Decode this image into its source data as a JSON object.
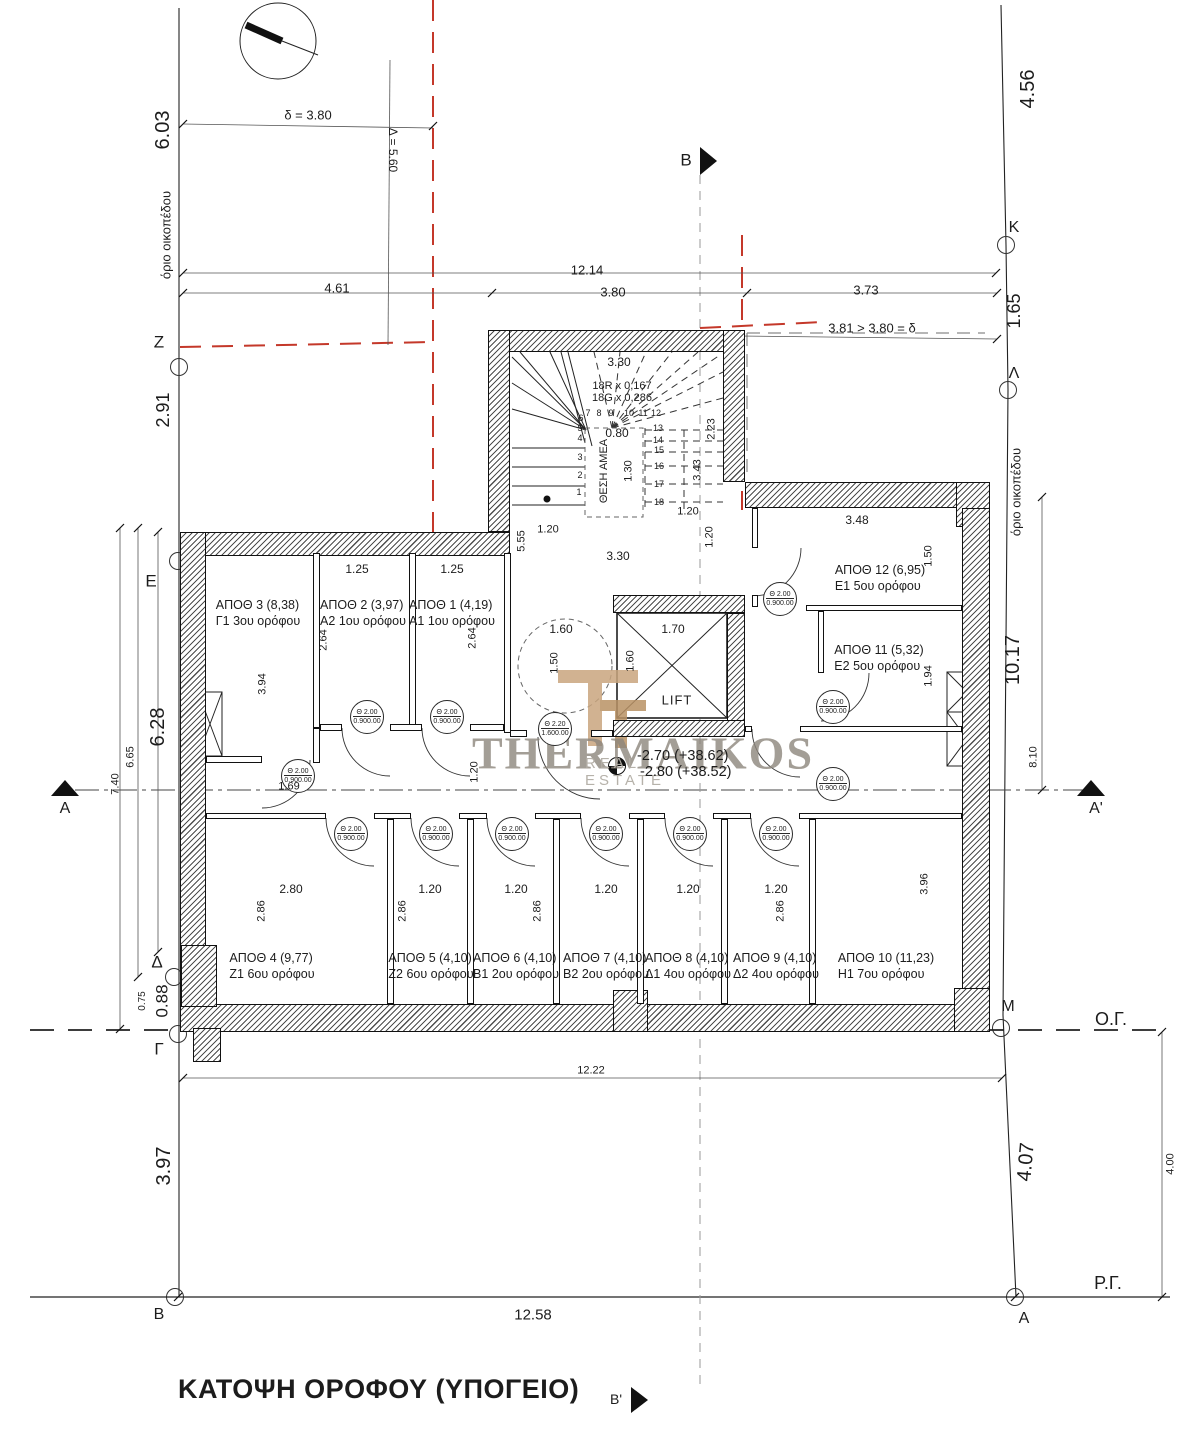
{
  "meta": {
    "title": "ΚΑΤΟΨΗ ΟΡΟΦΟΥ (ΥΠΟΓΕΙΟ)"
  },
  "watermark": {
    "brand": "THERMAIKOS",
    "subtitle": "REAL ESTATE",
    "logo_color": "#c9a57e",
    "brand_color": "#8d867c",
    "subtitle_color": "#b3aea6"
  },
  "lift": {
    "label": "LIFT"
  },
  "levels": {
    "line1": "-2.70 (+38.62)",
    "line2": "-2.80 (+38.52)"
  },
  "stairs": {
    "riser": "18R x 0,167",
    "going": "18G x 0,286",
    "amea": "ΘΕΣΗ ΑΜΕΑ",
    "steps": [
      {
        "n": "1",
        "x": 579,
        "y": 492
      },
      {
        "n": "2",
        "x": 580,
        "y": 475
      },
      {
        "n": "3",
        "x": 580,
        "y": 457
      },
      {
        "n": "4",
        "x": 580,
        "y": 438
      },
      {
        "n": "5",
        "x": 580,
        "y": 428
      },
      {
        "n": "6",
        "x": 581,
        "y": 418
      },
      {
        "n": "7",
        "x": 588,
        "y": 413
      },
      {
        "n": "8",
        "x": 599,
        "y": 413
      },
      {
        "n": "9",
        "x": 611,
        "y": 413
      },
      {
        "n": "10",
        "x": 629,
        "y": 413
      },
      {
        "n": "11",
        "x": 643,
        "y": 413
      },
      {
        "n": "12",
        "x": 656,
        "y": 413
      },
      {
        "n": "13",
        "x": 658,
        "y": 428
      },
      {
        "n": "14",
        "x": 658,
        "y": 440
      },
      {
        "n": "15",
        "x": 659,
        "y": 450
      },
      {
        "n": "16",
        "x": 659,
        "y": 466
      },
      {
        "n": "17",
        "x": 659,
        "y": 484
      },
      {
        "n": "18",
        "x": 659,
        "y": 502
      }
    ]
  },
  "doors": {
    "tag_line1": "Θ 2.00",
    "tag_line2": "0.900.00",
    "entrance_line1": "Θ 2.20",
    "entrance_line2": "1.600.00",
    "standard": [
      {
        "x": 366,
        "y": 716
      },
      {
        "x": 446,
        "y": 716
      },
      {
        "x": 297,
        "y": 775
      },
      {
        "x": 350,
        "y": 833
      },
      {
        "x": 435,
        "y": 833
      },
      {
        "x": 511,
        "y": 833
      },
      {
        "x": 605,
        "y": 833
      },
      {
        "x": 689,
        "y": 833
      },
      {
        "x": 775,
        "y": 833
      },
      {
        "x": 779,
        "y": 598
      },
      {
        "x": 832,
        "y": 706
      },
      {
        "x": 832,
        "y": 783
      }
    ],
    "entrance": {
      "x": 554,
      "y": 728
    }
  },
  "rooms": [
    {
      "name": "room-apoth-3",
      "label": "ΑΠΟΘ 3 (8,38)",
      "floor": "Γ1 3ου ορόφου",
      "x": 258,
      "y": 613
    },
    {
      "name": "room-apoth-2",
      "label": "ΑΠΟΘ 2 (3,97)",
      "floor": "Α2 1ου ορόφου",
      "x": 363,
      "y": 613
    },
    {
      "name": "room-apoth-1",
      "label": "ΑΠΟΘ 1 (4,19)",
      "floor": "Α1 1ου ορόφου",
      "x": 452,
      "y": 613
    },
    {
      "name": "room-apoth-12",
      "label": "ΑΠΟΘ 12 (6,95)",
      "floor": "Ε1 5ου ορόφου",
      "x": 880,
      "y": 578
    },
    {
      "name": "room-apoth-11",
      "label": "ΑΠΟΘ 11 (5,32)",
      "floor": "Ε2 5ου ορόφου",
      "x": 879,
      "y": 658
    },
    {
      "name": "room-apoth-4",
      "label": "ΑΠΟΘ 4 (9,77)",
      "floor": "Ζ1 6ου ορόφου",
      "x": 272,
      "y": 966
    },
    {
      "name": "room-apoth-5",
      "label": "ΑΠΟΘ 5 (4,10)",
      "floor": "Ζ2 6ου ορόφου",
      "x": 431,
      "y": 966
    },
    {
      "name": "room-apoth-6",
      "label": "ΑΠΟΘ 6 (4,10)",
      "floor": "Β1 2ου ορόφου",
      "x": 516,
      "y": 966
    },
    {
      "name": "room-apoth-7",
      "label": "ΑΠΟΘ 7 (4,10)",
      "floor": "Β2 2ου ορόφου",
      "x": 606,
      "y": 966
    },
    {
      "name": "room-apoth-8",
      "label": "ΑΠΟΘ 8 (4,10)",
      "floor": "Δ1 4ου ορόφου",
      "x": 688,
      "y": 966
    },
    {
      "name": "room-apoth-9",
      "label": "ΑΠΟΘ 9 (4,10)",
      "floor": "Δ2 4ου ορόφου",
      "x": 776,
      "y": 966
    },
    {
      "name": "room-apoth-10",
      "label": "ΑΠΟΘ 10 (11,23)",
      "floor": "Η1 7ου ορόφου",
      "x": 886,
      "y": 966
    }
  ],
  "labels": [
    {
      "name": "dim-603",
      "text": "6.03",
      "x": 163,
      "y": 130,
      "rot": -90,
      "fs": 20
    },
    {
      "name": "plot-boundary-label-left",
      "text": "όριο οικοπέδου",
      "x": 166,
      "y": 235,
      "rot": -90,
      "fs": 13
    },
    {
      "name": "dim-delta-380",
      "text": "δ = 3.80",
      "x": 308,
      "y": 115,
      "rot": 0,
      "fs": 13
    },
    {
      "name": "dim-Delta-560",
      "text": "Δ = 5.60",
      "x": 393,
      "y": 150,
      "rot": 90,
      "fs": 12
    },
    {
      "name": "dim-461",
      "text": "4.61",
      "x": 337,
      "y": 288,
      "rot": 0,
      "fs": 13
    },
    {
      "name": "dim-1214",
      "text": "12.14",
      "x": 587,
      "y": 270,
      "rot": 0,
      "fs": 13
    },
    {
      "name": "dim-380-top",
      "text": "3.80",
      "x": 613,
      "y": 292,
      "rot": 0,
      "fs": 13
    },
    {
      "name": "dim-373",
      "text": "3.73",
      "x": 866,
      "y": 290,
      "rot": 0,
      "fs": 13
    },
    {
      "name": "section-label-b-top",
      "text": "B",
      "x": 686,
      "y": 160,
      "rot": 0,
      "fs": 17
    },
    {
      "name": "dim-456",
      "text": "4.56",
      "x": 1028,
      "y": 89,
      "rot": -90,
      "fs": 20
    },
    {
      "name": "marker-K",
      "text": "K",
      "x": 1014,
      "y": 228,
      "rot": 0,
      "fs": 16
    },
    {
      "name": "dim-165",
      "text": "1.65",
      "x": 1014,
      "y": 311,
      "rot": -90,
      "fs": 18
    },
    {
      "name": "marker-Lambda",
      "text": "Λ",
      "x": 1014,
      "y": 374,
      "rot": 0,
      "fs": 16
    },
    {
      "name": "note-381-380",
      "text": "3.81 > 3.80 = δ",
      "x": 872,
      "y": 328,
      "rot": 0,
      "fs": 13
    },
    {
      "name": "marker-Z",
      "text": "Z",
      "x": 159,
      "y": 342,
      "rot": 0,
      "fs": 17
    },
    {
      "name": "dim-291",
      "text": "2.91",
      "x": 163,
      "y": 410,
      "rot": -90,
      "fs": 18
    },
    {
      "name": "marker-E",
      "text": "E",
      "x": 151,
      "y": 581,
      "rot": 0,
      "fs": 17
    },
    {
      "name": "dim-628",
      "text": "6.28",
      "x": 158,
      "y": 727,
      "rot": -90,
      "fs": 20
    },
    {
      "name": "dim-665",
      "text": "6.65",
      "x": 131,
      "y": 757,
      "rot": -90,
      "fs": 11
    },
    {
      "name": "dim-740",
      "text": "7.40",
      "x": 116,
      "y": 784,
      "rot": -90,
      "fs": 11
    },
    {
      "name": "section-label-a-left",
      "text": "A",
      "x": 65,
      "y": 809,
      "rot": 0,
      "fs": 16
    },
    {
      "name": "marker-Delta",
      "text": "Δ",
      "x": 157,
      "y": 962,
      "rot": 0,
      "fs": 17
    },
    {
      "name": "dim-088",
      "text": "0.88",
      "x": 162,
      "y": 1001,
      "rot": -90,
      "fs": 17
    },
    {
      "name": "dim-075",
      "text": "0.75",
      "x": 143,
      "y": 1001,
      "rot": -90,
      "fs": 10
    },
    {
      "name": "marker-Gamma",
      "text": "Γ",
      "x": 159,
      "y": 1049,
      "rot": 0,
      "fs": 17
    },
    {
      "name": "dim-397",
      "text": "3.97",
      "x": 164,
      "y": 1166,
      "rot": -90,
      "fs": 20
    },
    {
      "name": "marker-B-bottom",
      "text": "B",
      "x": 159,
      "y": 1315,
      "rot": 0,
      "fs": 16
    },
    {
      "name": "dim-1258",
      "text": "12.58",
      "x": 533,
      "y": 1315,
      "rot": 0,
      "fs": 15
    },
    {
      "name": "section-label-b-bottom",
      "text": "B'",
      "x": 616,
      "y": 1399,
      "rot": 0,
      "fs": 14
    },
    {
      "name": "dim-1222",
      "text": "12.22",
      "x": 591,
      "y": 1071,
      "rot": 0,
      "fs": 11
    },
    {
      "name": "marker-M",
      "text": "M",
      "x": 1008,
      "y": 1007,
      "rot": 0,
      "fs": 16
    },
    {
      "name": "building-line-label",
      "text": "Ο.Γ.",
      "x": 1111,
      "y": 1019,
      "rot": 0,
      "fs": 18
    },
    {
      "name": "dim-1017",
      "text": "10.17",
      "x": 1013,
      "y": 660,
      "rot": -90,
      "fs": 20
    },
    {
      "name": "dim-810",
      "text": "8.10",
      "x": 1034,
      "y": 757,
      "rot": -90,
      "fs": 11
    },
    {
      "name": "section-label-a-right",
      "text": "A'",
      "x": 1096,
      "y": 809,
      "rot": 0,
      "fs": 16
    },
    {
      "name": "plot-boundary-label-right",
      "text": "όριο οικοπέδου",
      "x": 1016,
      "y": 492,
      "rot": -90,
      "fs": 13
    },
    {
      "name": "dim-407",
      "text": "4.07",
      "x": 1026,
      "y": 1162,
      "rot": -85,
      "fs": 20
    },
    {
      "name": "dim-400",
      "text": "4.00",
      "x": 1171,
      "y": 1164,
      "rot": -90,
      "fs": 11
    },
    {
      "name": "street-line-label",
      "text": "Ρ.Γ.",
      "x": 1108,
      "y": 1283,
      "rot": 0,
      "fs": 18
    },
    {
      "name": "marker-A-bottom",
      "text": "A",
      "x": 1024,
      "y": 1319,
      "rot": 0,
      "fs": 16
    },
    {
      "name": "dim-stair-330",
      "text": "3.30",
      "x": 619,
      "y": 362,
      "rot": 0,
      "fs": 12
    },
    {
      "name": "dim-stair-080",
      "text": "0.80",
      "x": 617,
      "y": 433,
      "rot": 0,
      "fs": 12
    },
    {
      "name": "dim-stair-130",
      "text": "1.30",
      "x": 629,
      "y": 471,
      "rot": -90,
      "fs": 11
    },
    {
      "name": "dim-stair-223",
      "text": "2.23",
      "x": 712,
      "y": 429,
      "rot": -90,
      "fs": 11
    },
    {
      "name": "dim-stair-343",
      "text": "3.43",
      "x": 698,
      "y": 470,
      "rot": -90,
      "fs": 11
    },
    {
      "name": "dim-120-stair-right",
      "text": "1.20",
      "x": 688,
      "y": 512,
      "rot": 0,
      "fs": 11
    },
    {
      "name": "dim-120-stair-left",
      "text": "1.20",
      "x": 548,
      "y": 530,
      "rot": 0,
      "fs": 11
    },
    {
      "name": "dim-555",
      "text": "5.55",
      "x": 522,
      "y": 541,
      "rot": -90,
      "fs": 11
    },
    {
      "name": "dim-330-lobby",
      "text": "3.30",
      "x": 618,
      "y": 556,
      "rot": 0,
      "fs": 12
    },
    {
      "name": "dim-120-lobby-vert",
      "text": "1.20",
      "x": 710,
      "y": 537,
      "rot": -90,
      "fs": 11
    },
    {
      "name": "dim-160-lift",
      "text": "1.60",
      "x": 561,
      "y": 629,
      "rot": 0,
      "fs": 12
    },
    {
      "name": "dim-170-lift",
      "text": "1.70",
      "x": 673,
      "y": 629,
      "rot": 0,
      "fs": 12
    },
    {
      "name": "dim-150-lift",
      "text": "1.50",
      "x": 555,
      "y": 663,
      "rot": -90,
      "fs": 11
    },
    {
      "name": "dim-160-lift-vert",
      "text": "1.60",
      "x": 631,
      "y": 661,
      "rot": -90,
      "fs": 11
    },
    {
      "name": "dim-120-corr-left",
      "text": "1.20",
      "x": 475,
      "y": 772,
      "rot": -90,
      "fs": 11
    },
    {
      "name": "dim-125-a",
      "text": "1.25",
      "x": 357,
      "y": 569,
      "rot": 0,
      "fs": 12
    },
    {
      "name": "dim-125-b",
      "text": "1.25",
      "x": 452,
      "y": 569,
      "rot": 0,
      "fs": 12
    },
    {
      "name": "dim-264-a",
      "text": "2.64",
      "x": 324,
      "y": 640,
      "rot": -90,
      "fs": 11
    },
    {
      "name": "dim-264-b",
      "text": "2.64",
      "x": 473,
      "y": 638,
      "rot": -90,
      "fs": 11
    },
    {
      "name": "dim-394",
      "text": "3.94",
      "x": 263,
      "y": 684,
      "rot": -90,
      "fs": 11
    },
    {
      "name": "dim-169",
      "text": "1.69",
      "x": 289,
      "y": 787,
      "rot": 0,
      "fs": 11
    },
    {
      "name": "dim-348",
      "text": "3.48",
      "x": 857,
      "y": 520,
      "rot": 0,
      "fs": 12
    },
    {
      "name": "dim-150-right",
      "text": "1.50",
      "x": 929,
      "y": 556,
      "rot": -90,
      "fs": 11
    },
    {
      "name": "dim-194",
      "text": "1.94",
      "x": 929,
      "y": 676,
      "rot": -90,
      "fs": 11
    },
    {
      "name": "dim-396",
      "text": "3.96",
      "x": 925,
      "y": 884,
      "rot": -90,
      "fs": 11
    },
    {
      "name": "dim-280",
      "text": "2.80",
      "x": 291,
      "y": 889,
      "rot": 0,
      "fs": 12
    },
    {
      "name": "dim-120-r5",
      "text": "1.20",
      "x": 430,
      "y": 889,
      "rot": 0,
      "fs": 12
    },
    {
      "name": "dim-120-r6",
      "text": "1.20",
      "x": 516,
      "y": 889,
      "rot": 0,
      "fs": 12
    },
    {
      "name": "dim-120-r7",
      "text": "1.20",
      "x": 606,
      "y": 889,
      "rot": 0,
      "fs": 12
    },
    {
      "name": "dim-120-r8",
      "text": "1.20",
      "x": 688,
      "y": 889,
      "rot": 0,
      "fs": 12
    },
    {
      "name": "dim-120-r9",
      "text": "1.20",
      "x": 776,
      "y": 889,
      "rot": 0,
      "fs": 12
    },
    {
      "name": "dim-286-a",
      "text": "2.86",
      "x": 262,
      "y": 911,
      "rot": -90,
      "fs": 11
    },
    {
      "name": "dim-286-b",
      "text": "2.86",
      "x": 403,
      "y": 911,
      "rot": -90,
      "fs": 11
    },
    {
      "name": "dim-286-c",
      "text": "2.86",
      "x": 538,
      "y": 911,
      "rot": -90,
      "fs": 11
    },
    {
      "name": "dim-286-d",
      "text": "2.86",
      "x": 781,
      "y": 911,
      "rot": -90,
      "fs": 11
    }
  ]
}
